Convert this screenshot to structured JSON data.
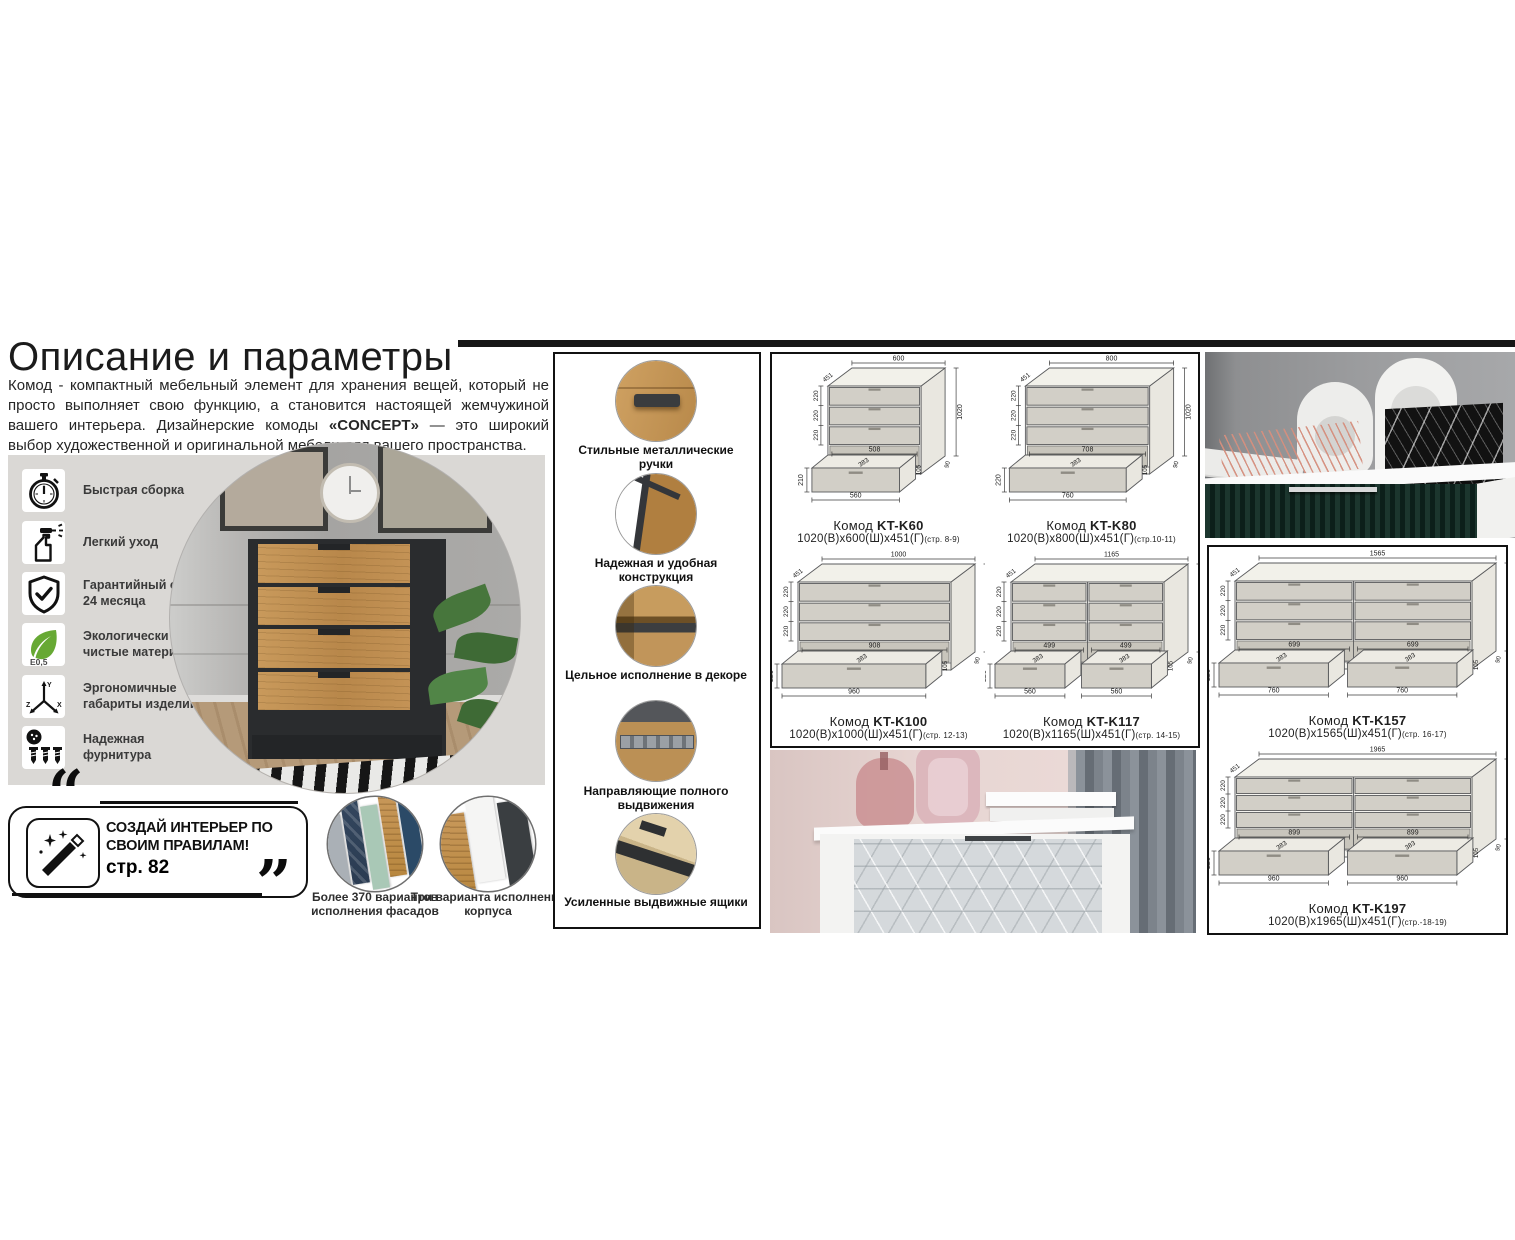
{
  "page": {
    "title": "Описание и параметры",
    "intro": {
      "part1": "Комод - компактный мебельный элемент для хранения вещей, который не просто выполняет свою функцию, а становится настоящей жемчужиной вашего интерьера. Дизайнерские комоды ",
      "bold": "«CONCEPT»",
      "part2": " — это широкий выбор художественной и оригинальной мебели для вашего пространства."
    }
  },
  "features": [
    {
      "icon": "stopwatch-icon",
      "label": "Быстрая сборка"
    },
    {
      "icon": "spray-bottle-icon",
      "label": "Легкий уход"
    },
    {
      "icon": "shield-check-icon",
      "label": "Гарантийный срок 24 месяца"
    },
    {
      "icon": "eco-leaf-icon",
      "eco_text": "E0,5",
      "label": "Экологически чистые материалы"
    },
    {
      "icon": "xyz-axes-icon",
      "label": "Эргономичные габариты изделий"
    },
    {
      "icon": "hardware-screws-icon",
      "label": "Надежная фурнитура"
    }
  ],
  "promo": {
    "icon": "magic-wand-icon",
    "text": "СОЗДАЙ ИНТЕРЬЕР ПО СВОИМ ПРАВИЛАМ!",
    "page_ref": "стр. 82",
    "quote_open": "“",
    "quote_close": "”"
  },
  "variants": [
    {
      "label": "Более 370 вариантов исполнения фасадов",
      "swatches": [
        "#aab0b6",
        "stripe",
        "#a9c8b6",
        "wood",
        "#2b4a67"
      ]
    },
    {
      "label": "Три варианта исполнения корпуса",
      "swatches": [
        "wood",
        "#f5f5f4",
        "#3a3e41"
      ]
    }
  ],
  "details": [
    {
      "photo": "metal-handle-photo",
      "label": "Стильные металлические ручки"
    },
    {
      "photo": "construction-corner-photo",
      "label": "Надежная и удобная конструкция"
    },
    {
      "photo": "decor-shelf-photo",
      "label": "Цельное исполнение в декоре"
    },
    {
      "photo": "drawer-slides-photo",
      "label": "Направляющие полного выдвижения"
    },
    {
      "photo": "drawer-bottom-photo",
      "label": "Усиленные выдвижные ящики"
    }
  ],
  "products": [
    {
      "name": "Комод",
      "code": "KT-K60",
      "size": "1020(В)x600(Ш)x451(Г)",
      "pages": "(стр. 8-9)",
      "drawing": {
        "width_mm": 600,
        "cols": 1,
        "dims": {
          "width": "600",
          "depth": "451",
          "height": "1020",
          "drawer_rows": [
            "220",
            "220",
            "220"
          ],
          "inner_width": [
            "508"
          ],
          "drawer_depth": "383",
          "drawer_front": "210",
          "drawer_side": "105",
          "bottom_width": [
            "560"
          ],
          "plinth": "90"
        }
      }
    },
    {
      "name": "Комод",
      "code": "KT-K80",
      "size": "1020(В)x800(Ш)x451(Г)",
      "pages": "(стр.10-11)",
      "drawing": {
        "width_mm": 800,
        "cols": 1,
        "dims": {
          "width": "800",
          "depth": "451",
          "height": "1020",
          "drawer_rows": [
            "220",
            "220",
            "220"
          ],
          "inner_width": [
            "708"
          ],
          "drawer_depth": "383",
          "drawer_front": "220",
          "drawer_side": "105",
          "bottom_width": [
            "760"
          ],
          "plinth": "90"
        }
      }
    },
    {
      "name": "Комод",
      "code": "KT-K100",
      "size": "1020(В)x1000(Ш)x451(Г)",
      "pages": "(стр. 12-13)",
      "drawing": {
        "width_mm": 1000,
        "cols": 1,
        "dims": {
          "width": "1000",
          "depth": "451",
          "height": "1020",
          "drawer_rows": [
            "220",
            "220",
            "220"
          ],
          "inner_width": [
            "908"
          ],
          "drawer_depth": "383",
          "drawer_front": "220",
          "drawer_side": "105",
          "bottom_width": [
            "960"
          ],
          "plinth": "90"
        }
      }
    },
    {
      "name": "Комод",
      "code": "KT-K117",
      "size": "1020(В)x1165(Ш)x451(Г)",
      "pages": "(стр. 14-15)",
      "drawing": {
        "width_mm": 1165,
        "cols": 2,
        "dims": {
          "width": "1165",
          "depth": "451",
          "height": "1020",
          "drawer_rows": [
            "220",
            "220",
            "220"
          ],
          "inner_width": [
            "499",
            "499"
          ],
          "drawer_depth": "383",
          "drawer_front": "220",
          "drawer_side": "105",
          "bottom_width": [
            "560",
            "560"
          ],
          "plinth": "90"
        }
      }
    },
    {
      "name": "Комод",
      "code": "KT-K157",
      "size": "1020(В)x1565(Ш)x451(Г)",
      "pages": "(стр. 16-17)",
      "drawing": {
        "width_mm": 1565,
        "cols": 2,
        "dims": {
          "width": "1565",
          "depth": "451",
          "height": "1020",
          "drawer_rows": [
            "220",
            "220",
            "220"
          ],
          "inner_width": [
            "699",
            "699"
          ],
          "drawer_depth": "383",
          "drawer_front": "220",
          "drawer_side": "105",
          "bottom_width": [
            "760",
            "760"
          ],
          "plinth": "90"
        }
      }
    },
    {
      "name": "Комод",
      "code": "KT-K197",
      "size": "1020(В)x1965(Ш)x451(Г)",
      "pages": "(стр.-18-19)",
      "drawing": {
        "width_mm": 1965,
        "cols": 2,
        "dims": {
          "width": "1965",
          "depth": "451",
          "height": "1020",
          "drawer_rows": [
            "220",
            "220",
            "220"
          ],
          "inner_width": [
            "899",
            "899"
          ],
          "drawer_depth": "383",
          "drawer_front": "220",
          "drawer_side": "105",
          "bottom_width": [
            "960",
            "960"
          ],
          "plinth": "90"
        }
      }
    }
  ],
  "photos": {
    "hero": "black-oak-commode-room-photo",
    "top_right": "green-sideboard-vases-photo",
    "bottom": "white-hex-commode-photo"
  },
  "colors": {
    "accent_wood": "#c49554",
    "panel_bg": "#dad8d5",
    "rule": "#161616",
    "drawing_front": "#f5f4ef",
    "drawing_drawer": "#d2cfc7"
  }
}
